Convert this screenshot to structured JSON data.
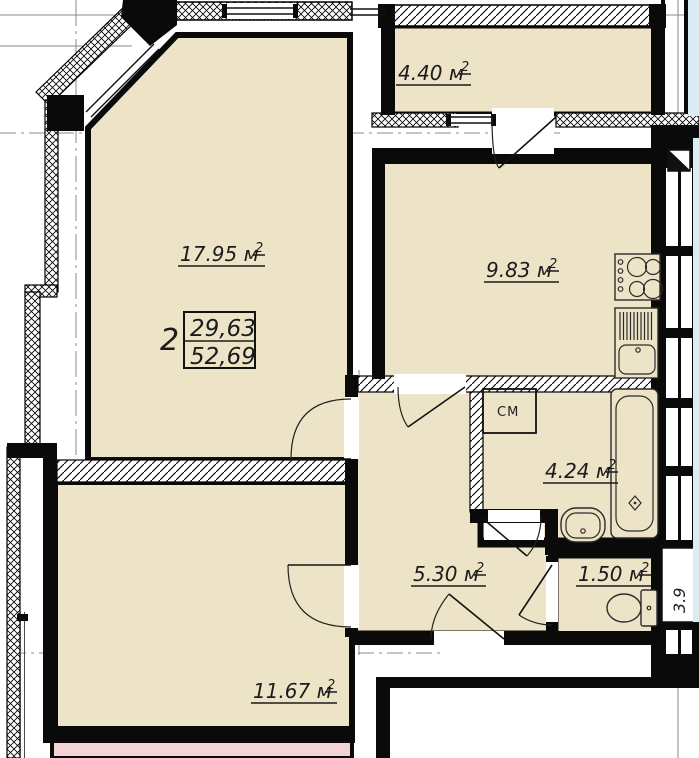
{
  "plan": {
    "colors": {
      "room_fill": "#EDE4C7",
      "adjacent_pink": "#F3D3D6",
      "adjacent_blue": "#D9EDF3",
      "wall": "#0a0a0a",
      "text": "#1b1b1b"
    },
    "stamp": {
      "number": "2",
      "upper": "29,63",
      "lower": "52,69"
    },
    "rooms": {
      "living": {
        "label": "17.95 м",
        "sup": "2"
      },
      "kitchen": {
        "label": "9.83 м",
        "sup": "2"
      },
      "balcony": {
        "label": "4.40 м",
        "sup": "2"
      },
      "bathroom": {
        "label": "4.24 м",
        "sup": "2"
      },
      "hallway": {
        "label": "5.30 м",
        "sup": "2"
      },
      "wc": {
        "label": "1.50 м",
        "sup": "2"
      },
      "bedroom": {
        "label": "11.67 м",
        "sup": "2"
      }
    },
    "fixtures": {
      "washing_machine": "СМ"
    },
    "annotations": {
      "shaft_depth": "3.9"
    }
  }
}
